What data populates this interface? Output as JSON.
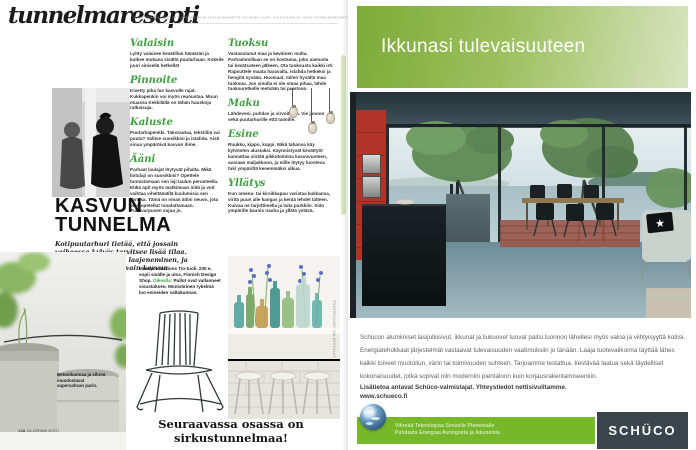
{
  "masthead": {
    "title": "tunnelmaresepti",
    "tagline": "SISUSTUSARKKITEHTI JA TUNNELMOINNIN TAITAJA MAARETTA TOIVONEN LAATII JOKA KUUKAUSI KODIN TUNNELMARESEPTIN."
  },
  "sections_col1": [
    {
      "heading": "Valaisin",
      "body": "Lyhty valaisee kevätillan hämärän ja kulkee mukana sisältä puutarhaan. Kokeile juuri sinisellä hetkellä!"
    },
    {
      "heading": "Pinnoite",
      "body": "Kivetty piha luo kasvulle rajat. Kukkapenkin voi myös reunustaa. Muun muassa Kekkilällä on tähän hauskoja ratkaisuja."
    },
    {
      "heading": "Kaluste",
      "body": "Puutarhapenkki. Takorautaa, tekstiiliä vai puuta? Valitse suosikkisi ja istahda. Aisti sinua ympäröivä kasvun ihme."
    },
    {
      "heading": "Ääni",
      "body": "Parhaat laulajat löytyvät pihalta. Mikä lintulaji on suosikkisi? Opettele tunnistamaan sen laji laulun perusteella. Ehkä opit myös matkimaan niitä ja voit vaihtaa viheltämällä kuulumisia sen kanssa. Tämä on oman äitini neuvo, jota olen opetellut noudattamaan. Punavarpusen sujuu jo."
    }
  ],
  "sections_col2": [
    {
      "heading": "Tuoksu",
      "body": "Vastasulanut maa ja keväinen multa. Parhaimmillaan se on kosteana, joko aamusta tai kevätsateen jälkeen. Ota tuoksusta kaikki irti: Rapsuttele maata haravalla, istahda hetkeksi ja hengitä syvään. Huomaat, miten hyvältä maa tuoksuu. Jos sinulla ei ole omaa pihaa, lähde tuoksuretkelle metsään tai puistoon."
    },
    {
      "heading": "Maku",
      "body": "Lähdevesi, puhdas ja virvoittava. Vie janoon sekä puutarhurille että taimille."
    },
    {
      "heading": "Esine",
      "body": "Ruukku, kippo, kuppi. Mikä tahansa käy kylvösten alustaksi. Käynnistyvät kevättyöt kannattaa siirtää pikkutoimina kasvuvuoteen, avaraan maljakkoon, ja niille löytyy luonteva tuki ympäriltä kesemmäksi alkua."
    },
    {
      "heading": "Yllätys",
      "body": "Kun omena- tai kirsikkapuu varistaa kukkansa, viritä puun alle kangas ja kerää lehdet talteen. Kuivaa ne tarjottimella ja laita purkkiin. Sido ympärille kaunis nauha ja yllätä ystävä."
    }
  ],
  "feature": {
    "title_line1": "KASVUN",
    "title_line2": "TUNNELMA",
    "intro": "Kotipuutarhuri tietää, että jossain vaiheessa kylvös tarvitsee lisää tilaa. Kasvuun liittyy aina laajeneminen, ja sen tukeminen on avain kasvun tunnelmaan."
  },
  "captions": {
    "product_bold": "Massproductions Tio-tuoli, 230 e, sopii sisälle ja ulos, Finnish Design Shop. ",
    "product_lead": "Oikealla: ",
    "product_rest": "Pullot ovat vallanneet sisustuksen. Monivärinen rykelmä luo esineiden valtakunnan.",
    "pots": "Betoniharmaa ja vihreä muodostavat supervahvan parin.",
    "photo_credit": "TUOTEKUVAT: VALMISTAJAT"
  },
  "teaser": "Seuraavassa osassa on sirkustunnelmaa!",
  "folio": {
    "page": "138",
    "magazine": "GLORIAN KOTI"
  },
  "ad": {
    "headline": "Ikkunasi tulevaisuuteen",
    "body": "Schücon alumiiniset lasijulkisivut, ikkunat ja liukuovet tuovat paitsi luonnon lähellesi myös valoa ja viihtyisyyttä kotiisi. Energiatehokkaat järjestelmät vastaavat tulevaisuuden vaatimuksiin jo tänään. Laaja tuotevalikoima täyttää lähes kaikki toiveet muotoilun, värin tai toimivuuden suhteen. Tarjoamme testattua, kestävää laatua sekä täydelliset kokonaisuudet, jotka sopivat niin moderniin pientaloon kuin korjausrakentamiseenkin.",
    "contact": "Lisätietoa antavat Schüco-valmistajat. Yhteystiedot nettisivuiltamme.",
    "website": "www.schueco.fi",
    "slogan1": "Vihreää Teknologiaa Siniselle Planeetalle",
    "slogan2": "Puhdasta Energiaa Auringosta ja Ikkunoista",
    "logo": "SCHÜCO"
  },
  "icons": {
    "star": "★"
  },
  "colors": {
    "accent_green": "#3fa03f",
    "schuco_green": "#76b82a",
    "schuco_dark": "#39444c",
    "header_gradient_from": "#7cab38",
    "header_gradient_to": "#d9e4c0"
  }
}
